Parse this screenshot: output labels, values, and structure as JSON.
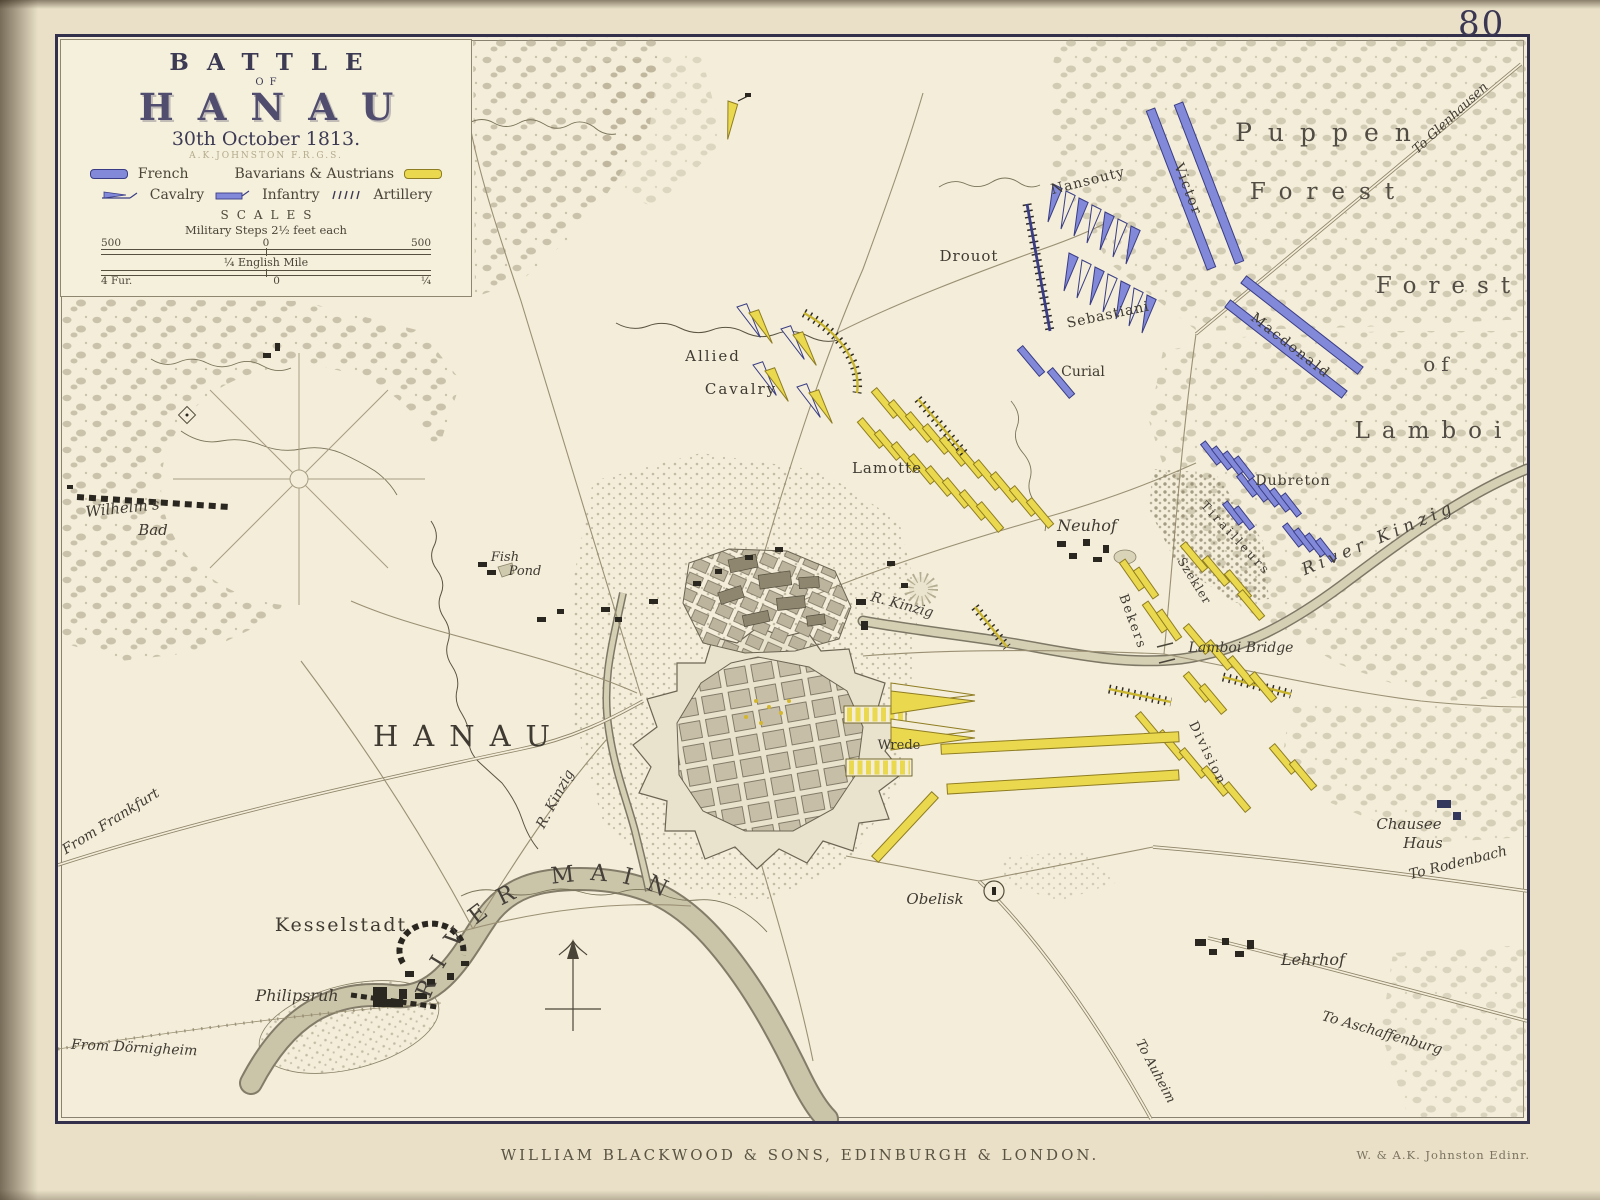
{
  "page": {
    "number": "80",
    "publisher_imprint": "WILLIAM BLACKWOOD & SONS, EDINBURGH & LONDON.",
    "engraver_imprint": "W. & A.K. Johnston Edinr."
  },
  "cartouche": {
    "title_line1": "BATTLE",
    "title_line2": "OF",
    "title_line3": "HANAU",
    "date_line": "30th October 1813.",
    "author_line": "A.K.JOHNSTON F.R.G.S.",
    "legend": {
      "french_label": "French",
      "bavarians_label": "Bavarians & Austrians",
      "cavalry_label": "Cavalry",
      "infantry_label": "Infantry",
      "artillery_label": "Artillery"
    },
    "scales": {
      "heading": "SCALES",
      "steps_line": "Military Steps 2½ feet each",
      "bar1_left": "500",
      "bar1_mid": "0",
      "bar1_right": "500",
      "mile_line": "¼ English Mile",
      "bar2_left": "4 Fur.",
      "bar2_mid": "0",
      "bar2_right": "¼"
    }
  },
  "colors": {
    "french_blue": "#8289d9",
    "allied_yellow": "#ead94f",
    "paper": "#f3edd9",
    "ink": "#4a4539"
  },
  "forest_labels": {
    "puppen": "Puppen",
    "forest_upper": "Forest",
    "forest_lower": "Forest",
    "of": "of",
    "lamboi": "Lamboi"
  },
  "places": {
    "hanau": "HANAU",
    "kesselstadt": "Kesselstadt",
    "philipsruh": "Philipsruh",
    "wilhelms_bad_1": "Wilhelm's",
    "wilhelms_bad_2": "Bad",
    "fish_pond_1": "Fish",
    "fish_pond_2": "Pond",
    "neuhof": "Neuhof",
    "lehrhof": "Lehrhof",
    "chausee_haus_1": "Chausee",
    "chausee_haus_2": "Haus",
    "obelisk": "Obelisk",
    "lamboi_bridge": "Lamboi Bridge"
  },
  "waterways": {
    "river_main": "RIVER MAIN",
    "river_kinzig": "River Kinzig",
    "r_kinzig_west": "R. Kinzig",
    "r_kinzig_east": "R. Kinzig"
  },
  "routes": {
    "to_glenhausen": "To Glenhausen",
    "to_rodenbach": "To Rodenbach",
    "to_aschaffenburg": "To Aschaffenburg",
    "to_auheim": "To Auheim",
    "from_frankfurt": "From Frankfurt",
    "from_dornigheim": "From Dörnigheim"
  },
  "units_french": {
    "victor": "Victor",
    "macdonald": "Macdonald",
    "nansouty": "Nansouty",
    "sebastiani": "Sebastiani",
    "drouot": "Drouot",
    "curial": "Curial",
    "dubreton": "Dubreton"
  },
  "units_allied": {
    "allied_cavalry_1": "Allied",
    "allied_cavalry_2": "Cavalry",
    "lamotte": "Lamotte",
    "wrede": "Wrede",
    "bekers": "Bekers",
    "szekler": "Szekler",
    "tirailleurs": "Tirailleurs",
    "division": "Division"
  }
}
